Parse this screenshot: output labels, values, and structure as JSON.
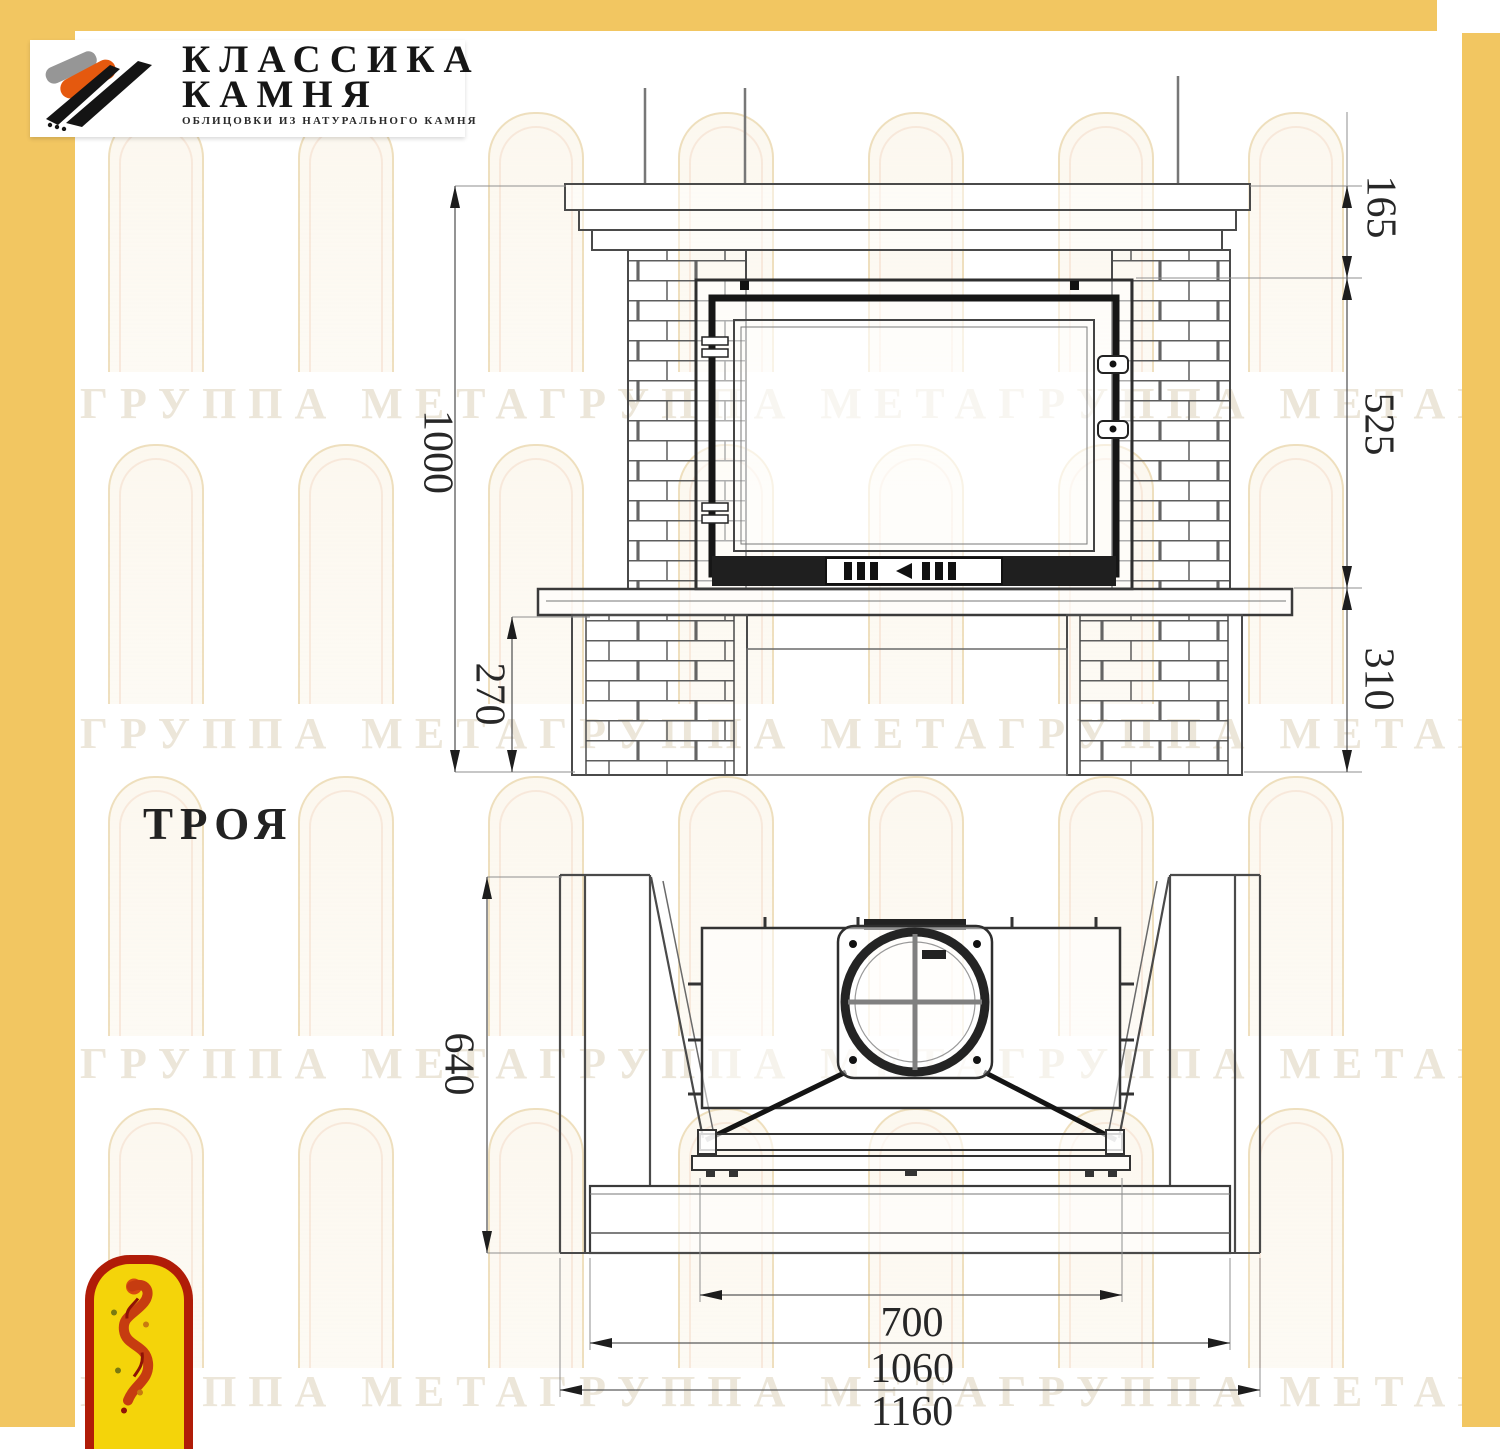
{
  "logo": {
    "line1": "КЛАССИКА",
    "line2": "КАМНЯ",
    "subtitle": "ОБЛИЦОВКИ ИЗ НАТУРАЛЬНОГО КАМНЯ"
  },
  "drawing": {
    "title": "ТРОЯ"
  },
  "front_view": {
    "dims": {
      "overall_height": "1000",
      "plinth_height": "270",
      "mantel_to_opening": "165",
      "opening_height": "525",
      "hearth_zone_height": "310"
    }
  },
  "top_view": {
    "dims": {
      "depth": "640",
      "opening_width": "700",
      "hearth_width": "1060",
      "overall_width": "1160"
    }
  },
  "watermark": {
    "row": "ГРУППА МЕТАГРУППА МЕТАГРУППА МЕТАГРУППА МЕТАГРУППА МЕТА"
  },
  "colors": {
    "frame": "#f2c661",
    "line_dark": "#1d1d1d",
    "line_gray": "#4a4a4a",
    "emblem_red": "#b01c08",
    "emblem_yellow": "#f4d40a",
    "logo_orange": "#e5590e"
  }
}
